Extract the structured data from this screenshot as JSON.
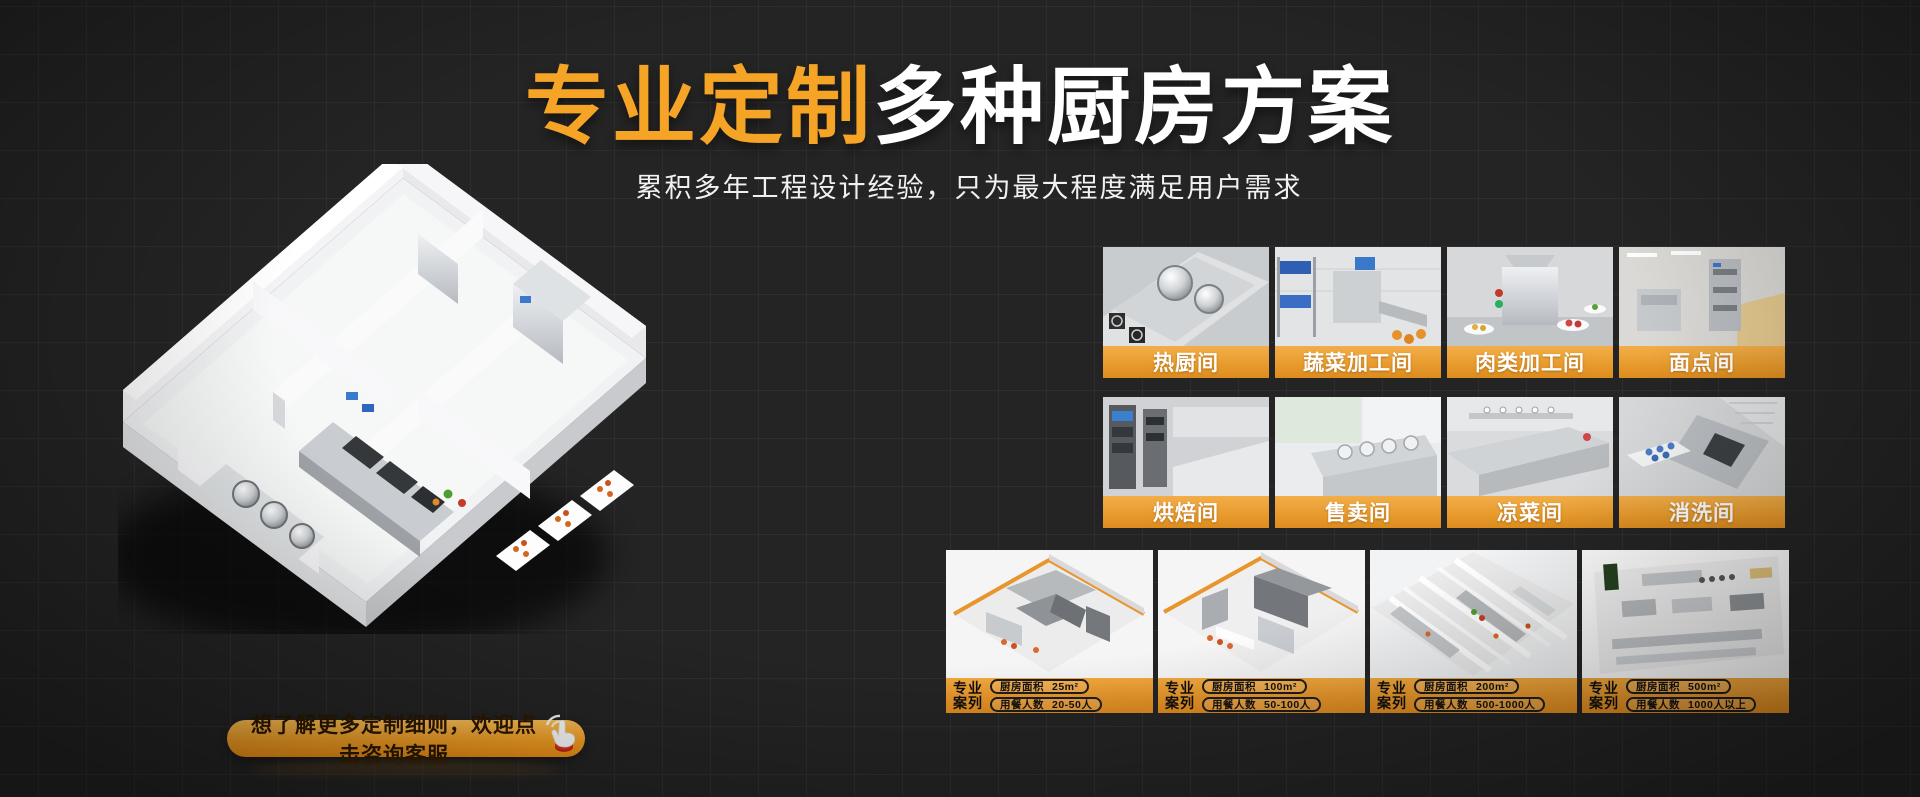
{
  "page": {
    "background": "#242424",
    "grid_line": "#2e2e30",
    "accent_orange": "#f6a426",
    "label_bar_orange": "#e79a2c"
  },
  "hero": {
    "title_highlight": "专业定制",
    "title_rest": "多种厨房方案",
    "subtitle": "累积多年工程设计经验，只为最大程度满足用户需求"
  },
  "cta": {
    "label": "想了解更多定制细则，欢迎点击咨询客服",
    "icon": "click-hand-icon"
  },
  "rooms": {
    "items": [
      {
        "label": "热厨间",
        "photo": "hot-kitchen-photo"
      },
      {
        "label": "蔬菜加工间",
        "photo": "vegetable-processing-photo"
      },
      {
        "label": "肉类加工间",
        "photo": "meat-processing-photo"
      },
      {
        "label": "面点间",
        "photo": "pastry-room-photo"
      },
      {
        "label": "烘焙间",
        "photo": "baking-room-photo"
      },
      {
        "label": "售卖间",
        "photo": "serving-room-photo"
      },
      {
        "label": "凉菜间",
        "photo": "cold-dish-room-photo"
      },
      {
        "label": "消洗间",
        "photo": "dishwashing-room-photo"
      }
    ]
  },
  "cases": {
    "tag_line1": "专业",
    "tag_line2": "案列",
    "items": [
      {
        "area_label": "厨房面积",
        "area_value": "25m²",
        "diners_label": "用餐人数",
        "diners_value": "20-50人"
      },
      {
        "area_label": "厨房面积",
        "area_value": "100m²",
        "diners_label": "用餐人数",
        "diners_value": "50-100人"
      },
      {
        "area_label": "厨房面积",
        "area_value": "200m²",
        "diners_label": "用餐人数",
        "diners_value": "500-1000人"
      },
      {
        "area_label": "厨房面积",
        "area_value": "500m²",
        "diners_label": "用餐人数",
        "diners_value": "1000人以上"
      }
    ]
  }
}
